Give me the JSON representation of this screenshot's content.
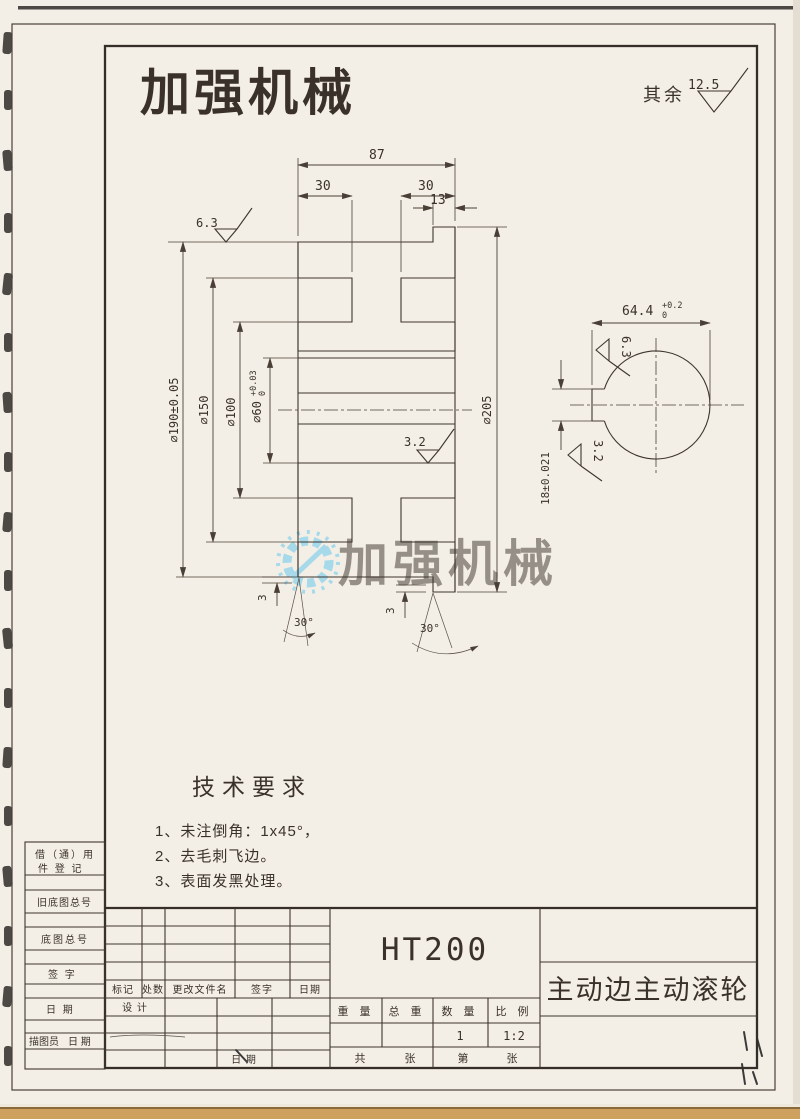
{
  "page": {
    "logo_text": "加强机械",
    "logo_color": "#e8120e",
    "watermark_text": "加强机械",
    "watermark_color": "#5bc4ec",
    "surface_note_label": "其余",
    "surface_note_value": "12.5"
  },
  "drawing": {
    "dims": {
      "width_total": "87",
      "groove_left": "30",
      "groove_right": "30",
      "flange_width": "13",
      "dia_outer": "⌀190±0.05",
      "dia_groove": "⌀150",
      "dia_hub": "⌀100",
      "dia_bore": "⌀60",
      "dia_bore_tol_up": "+0.03",
      "dia_bore_tol_dn": "0",
      "dia_flange": "⌀205",
      "rough_top": "6.3",
      "rough_bore": "3.2",
      "chamfer_left": "3",
      "angle_left": "30°",
      "chamfer_right": "3",
      "angle_right": "30°"
    },
    "side_view": {
      "keyway_depth": "64.4",
      "keyway_depth_tol_up": "+0.2",
      "keyway_depth_tol_dn": "0",
      "rough_key_top": "6.3",
      "rough_key_bottom": "3.2",
      "keyway_width": "18±0.021"
    }
  },
  "tech_req": {
    "title": "技术要求",
    "items": [
      "1、未注倒角：1x45°，",
      "2、去毛刺飞边。",
      "3、表面发黑处理。"
    ]
  },
  "title_block": {
    "material": "HT200",
    "part_name": "主动边主动滚轮",
    "table_headers": [
      "重 量",
      "总 重",
      "数 量",
      "比 例"
    ],
    "quantity": "1",
    "scale": "1:2",
    "sheet_total_prefix": "共",
    "sheet_total_suffix": "张",
    "sheet_no_prefix": "第",
    "sheet_no_suffix": "张",
    "rev_headers": [
      "标记",
      "处数",
      "更改文件名",
      "签字",
      "日期"
    ],
    "design_label": "设 计",
    "bottom_date_label": "日 期",
    "left_col": {
      "borrow_line1": "借（通）用",
      "borrow_line2": "件 登 记",
      "old_master_no": "旧底图总号",
      "master_no": "底图总号",
      "sign": "签  字",
      "date": "日  期",
      "tracer": "描图员",
      "tracer_date": "日 期"
    }
  }
}
